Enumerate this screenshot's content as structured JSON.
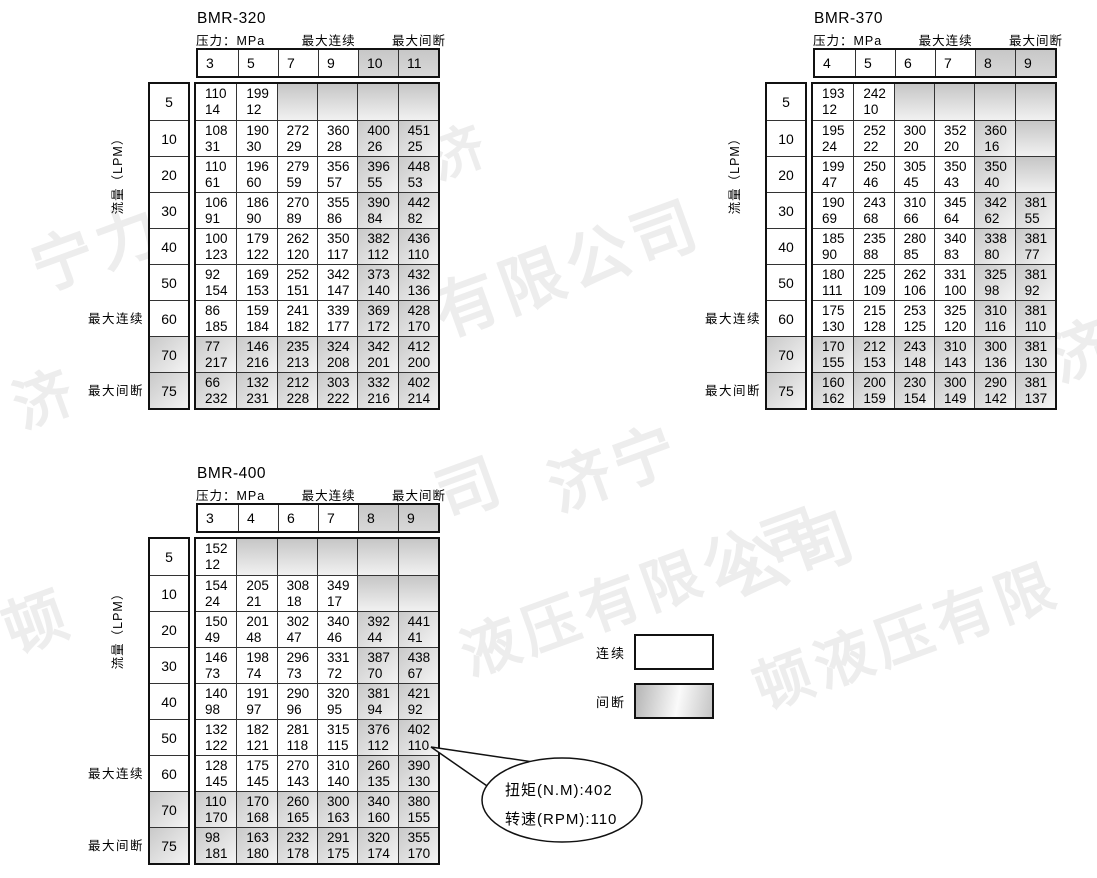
{
  "labels": {
    "pressure": "压力：MPa",
    "max_continuous": "最大连续",
    "max_intermittent": "最大间断",
    "flow": "流量（LPM）"
  },
  "legend": {
    "continuous": "连续",
    "intermittent": "间断"
  },
  "callout": {
    "torque": "扭矩(N.M):402",
    "speed": "转速(RPM):110"
  },
  "watermark": {
    "fragments": [
      "宁力",
      "济",
      "有限公司",
      "济宁",
      "公司",
      "液压有限公司",
      "顿液压有限",
      "顿",
      "济",
      "司",
      "济"
    ]
  },
  "tables": [
    {
      "title": "BMR-320",
      "pressure_columns": [
        "3",
        "5",
        "7",
        "9",
        "10",
        "11"
      ],
      "shaded_cols": [
        4,
        5
      ],
      "rows": [
        {
          "flow": "5",
          "shaded": false,
          "cells": [
            [
              "110",
              "14"
            ],
            [
              "199",
              "12"
            ],
            null,
            null,
            null,
            null
          ]
        },
        {
          "flow": "10",
          "shaded": false,
          "cells": [
            [
              "108",
              "31"
            ],
            [
              "190",
              "30"
            ],
            [
              "272",
              "29"
            ],
            [
              "360",
              "28"
            ],
            [
              "400",
              "26"
            ],
            [
              "451",
              "25"
            ]
          ]
        },
        {
          "flow": "20",
          "shaded": false,
          "cells": [
            [
              "110",
              "61"
            ],
            [
              "196",
              "60"
            ],
            [
              "279",
              "59"
            ],
            [
              "356",
              "57"
            ],
            [
              "396",
              "55"
            ],
            [
              "448",
              "53"
            ]
          ]
        },
        {
          "flow": "30",
          "shaded": false,
          "cells": [
            [
              "106",
              "91"
            ],
            [
              "186",
              "90"
            ],
            [
              "270",
              "89"
            ],
            [
              "355",
              "86"
            ],
            [
              "390",
              "84"
            ],
            [
              "442",
              "82"
            ]
          ]
        },
        {
          "flow": "40",
          "shaded": false,
          "cells": [
            [
              "100",
              "123"
            ],
            [
              "179",
              "122"
            ],
            [
              "262",
              "120"
            ],
            [
              "350",
              "117"
            ],
            [
              "382",
              "112"
            ],
            [
              "436",
              "110"
            ]
          ]
        },
        {
          "flow": "50",
          "shaded": false,
          "cells": [
            [
              "92",
              "154"
            ],
            [
              "169",
              "153"
            ],
            [
              "252",
              "151"
            ],
            [
              "342",
              "147"
            ],
            [
              "373",
              "140"
            ],
            [
              "432",
              "136"
            ]
          ]
        },
        {
          "flow": "60",
          "shaded": false,
          "cells": [
            [
              "86",
              "185"
            ],
            [
              "159",
              "184"
            ],
            [
              "241",
              "182"
            ],
            [
              "339",
              "177"
            ],
            [
              "369",
              "172"
            ],
            [
              "428",
              "170"
            ]
          ]
        },
        {
          "flow": "70",
          "shaded": true,
          "cells": [
            [
              "77",
              "217"
            ],
            [
              "146",
              "216"
            ],
            [
              "235",
              "213"
            ],
            [
              "324",
              "208"
            ],
            [
              "342",
              "201"
            ],
            [
              "412",
              "200"
            ]
          ]
        },
        {
          "flow": "75",
          "shaded": true,
          "cells": [
            [
              "66",
              "232"
            ],
            [
              "132",
              "231"
            ],
            [
              "212",
              "228"
            ],
            [
              "303",
              "222"
            ],
            [
              "332",
              "216"
            ],
            [
              "402",
              "214"
            ]
          ]
        }
      ]
    },
    {
      "title": "BMR-370",
      "pressure_columns": [
        "4",
        "5",
        "6",
        "7",
        "8",
        "9"
      ],
      "shaded_cols": [
        4,
        5
      ],
      "rows": [
        {
          "flow": "5",
          "shaded": false,
          "cells": [
            [
              "193",
              "12"
            ],
            [
              "242",
              "10"
            ],
            null,
            null,
            null,
            null
          ]
        },
        {
          "flow": "10",
          "shaded": false,
          "cells": [
            [
              "195",
              "24"
            ],
            [
              "252",
              "22"
            ],
            [
              "300",
              "20"
            ],
            [
              "352",
              "20"
            ],
            [
              "360",
              "16"
            ],
            null
          ]
        },
        {
          "flow": "20",
          "shaded": false,
          "cells": [
            [
              "199",
              "47"
            ],
            [
              "250",
              "46"
            ],
            [
              "305",
              "45"
            ],
            [
              "350",
              "43"
            ],
            [
              "350",
              "40"
            ],
            null
          ]
        },
        {
          "flow": "30",
          "shaded": false,
          "cells": [
            [
              "190",
              "69"
            ],
            [
              "243",
              "68"
            ],
            [
              "310",
              "66"
            ],
            [
              "345",
              "64"
            ],
            [
              "342",
              "62"
            ],
            [
              "381",
              "55"
            ]
          ]
        },
        {
          "flow": "40",
          "shaded": false,
          "cells": [
            [
              "185",
              "90"
            ],
            [
              "235",
              "88"
            ],
            [
              "280",
              "85"
            ],
            [
              "340",
              "83"
            ],
            [
              "338",
              "80"
            ],
            [
              "381",
              "77"
            ]
          ]
        },
        {
          "flow": "50",
          "shaded": false,
          "cells": [
            [
              "180",
              "111"
            ],
            [
              "225",
              "109"
            ],
            [
              "262",
              "106"
            ],
            [
              "331",
              "100"
            ],
            [
              "325",
              "98"
            ],
            [
              "381",
              "92"
            ]
          ]
        },
        {
          "flow": "60",
          "shaded": false,
          "cells": [
            [
              "175",
              "130"
            ],
            [
              "215",
              "128"
            ],
            [
              "253",
              "125"
            ],
            [
              "325",
              "120"
            ],
            [
              "310",
              "116"
            ],
            [
              "381",
              "110"
            ]
          ]
        },
        {
          "flow": "70",
          "shaded": true,
          "cells": [
            [
              "170",
              "155"
            ],
            [
              "212",
              "153"
            ],
            [
              "243",
              "148"
            ],
            [
              "310",
              "143"
            ],
            [
              "300",
              "136"
            ],
            [
              "381",
              "130"
            ]
          ]
        },
        {
          "flow": "75",
          "shaded": true,
          "cells": [
            [
              "160",
              "162"
            ],
            [
              "200",
              "159"
            ],
            [
              "230",
              "154"
            ],
            [
              "300",
              "149"
            ],
            [
              "290",
              "142"
            ],
            [
              "381",
              "137"
            ]
          ]
        }
      ]
    },
    {
      "title": "BMR-400",
      "pressure_columns": [
        "3",
        "4",
        "6",
        "7",
        "8",
        "9"
      ],
      "shaded_cols": [
        4,
        5
      ],
      "rows": [
        {
          "flow": "5",
          "shaded": false,
          "cells": [
            [
              "152",
              "12"
            ],
            null,
            null,
            null,
            null,
            null
          ]
        },
        {
          "flow": "10",
          "shaded": false,
          "cells": [
            [
              "154",
              "24"
            ],
            [
              "205",
              "21"
            ],
            [
              "308",
              "18"
            ],
            [
              "349",
              "17"
            ],
            null,
            null
          ]
        },
        {
          "flow": "20",
          "shaded": false,
          "cells": [
            [
              "150",
              "49"
            ],
            [
              "201",
              "48"
            ],
            [
              "302",
              "47"
            ],
            [
              "340",
              "46"
            ],
            [
              "392",
              "44"
            ],
            [
              "441",
              "41"
            ]
          ]
        },
        {
          "flow": "30",
          "shaded": false,
          "cells": [
            [
              "146",
              "73"
            ],
            [
              "198",
              "74"
            ],
            [
              "296",
              "73"
            ],
            [
              "331",
              "72"
            ],
            [
              "387",
              "70"
            ],
            [
              "438",
              "67"
            ]
          ]
        },
        {
          "flow": "40",
          "shaded": false,
          "cells": [
            [
              "140",
              "98"
            ],
            [
              "191",
              "97"
            ],
            [
              "290",
              "96"
            ],
            [
              "320",
              "95"
            ],
            [
              "381",
              "94"
            ],
            [
              "421",
              "92"
            ]
          ]
        },
        {
          "flow": "50",
          "shaded": false,
          "cells": [
            [
              "132",
              "122"
            ],
            [
              "182",
              "121"
            ],
            [
              "281",
              "118"
            ],
            [
              "315",
              "115"
            ],
            [
              "376",
              "112"
            ],
            [
              "402",
              "110"
            ]
          ]
        },
        {
          "flow": "60",
          "shaded": false,
          "cells": [
            [
              "128",
              "145"
            ],
            [
              "175",
              "145"
            ],
            [
              "270",
              "143"
            ],
            [
              "310",
              "140"
            ],
            [
              "260",
              "135"
            ],
            [
              "390",
              "130"
            ]
          ]
        },
        {
          "flow": "70",
          "shaded": true,
          "cells": [
            [
              "110",
              "170"
            ],
            [
              "170",
              "168"
            ],
            [
              "260",
              "165"
            ],
            [
              "300",
              "163"
            ],
            [
              "340",
              "160"
            ],
            [
              "380",
              "155"
            ]
          ]
        },
        {
          "flow": "75",
          "shaded": true,
          "cells": [
            [
              "98",
              "181"
            ],
            [
              "163",
              "180"
            ],
            [
              "232",
              "178"
            ],
            [
              "291",
              "175"
            ],
            [
              "320",
              "174"
            ],
            [
              "355",
              "170"
            ]
          ]
        }
      ]
    }
  ]
}
